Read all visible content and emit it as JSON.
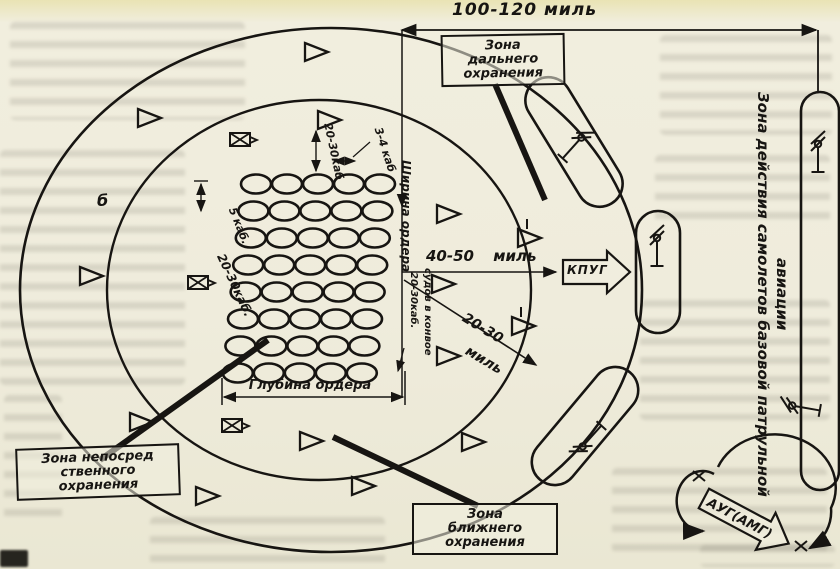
{
  "figure": {
    "part_label": "б",
    "measurements": {
      "top_range": "100-120 миль",
      "mid_range": "40-50  миль",
      "inner_range_value": "20-30",
      "inner_range_unit": "миль",
      "escort_gap_top": "20-30каб",
      "ship_gap_row": "3-4 каб",
      "row_gap": "5 каб.",
      "escort_gap_left": "20-30каб.",
      "column_gap": "20-30каб.",
      "column_gap_note": "судов в конвое",
      "order_width": "Ширина ордера",
      "order_depth": "Глубина ордера"
    },
    "zones": {
      "far": [
        "Зона",
        "дальнего",
        "охранения"
      ],
      "near": [
        "Зона",
        "ближнего",
        "охранения"
      ],
      "immediate": [
        "Зона непосред",
        "ственного",
        "охранения"
      ],
      "aviation_main": "Зона действия самолетов базовой патрульной",
      "aviation_tail": "авиации"
    },
    "units": {
      "kpug": "КПУГ",
      "aug": "АУГ(АМГ)"
    }
  },
  "diagram": {
    "ink": "#171512",
    "convoy_grid": {
      "rows": 8,
      "cols": 5,
      "x0": 256,
      "y0": 184,
      "col_step": 31,
      "row_step": 27,
      "row_shear": -2.6,
      "rx": 15,
      "ry": 9.5
    },
    "escorts": [
      [
        138,
        118,
        0
      ],
      [
        305,
        52,
        0
      ],
      [
        318,
        120,
        0
      ],
      [
        80,
        276,
        0
      ],
      [
        130,
        422,
        0
      ],
      [
        196,
        496,
        0
      ],
      [
        352,
        486,
        0
      ],
      [
        300,
        441,
        0
      ],
      [
        437,
        214,
        0
      ],
      [
        432,
        284,
        0
      ],
      [
        437,
        356,
        0
      ],
      [
        518,
        238,
        1
      ],
      [
        512,
        326,
        1
      ],
      [
        462,
        442,
        0
      ]
    ],
    "guard_ships": [
      [
        240,
        140
      ],
      [
        198,
        283
      ],
      [
        232,
        426
      ]
    ],
    "submarines": [
      [
        818,
        158,
        0
      ],
      [
        806,
        408,
        -80
      ],
      [
        657,
        252,
        0
      ],
      [
        572,
        148,
        42
      ],
      [
        592,
        436,
        222
      ]
    ]
  }
}
